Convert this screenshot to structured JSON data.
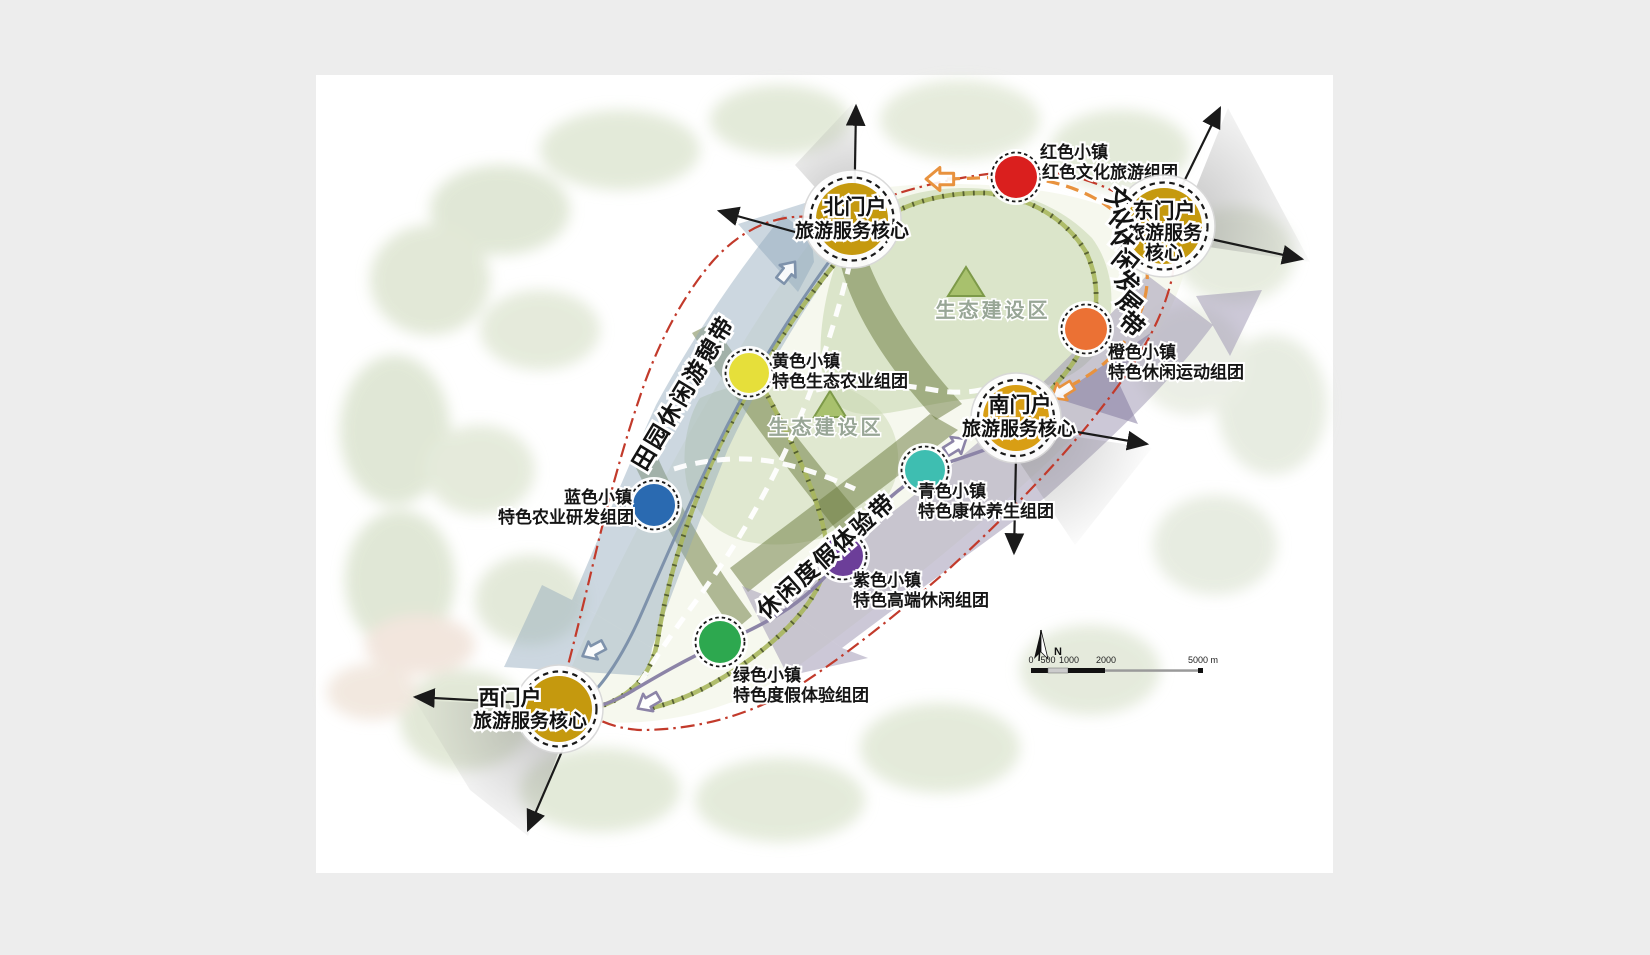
{
  "page": {
    "background": "#ededed",
    "canvas": "#ffffff"
  },
  "gateways": {
    "north": {
      "name": "北门户",
      "sub": "旅游服务核心",
      "color": "#C5990E"
    },
    "east": {
      "l1": "东门户",
      "l2": "旅游服务",
      "l3": "核心",
      "color": "#C5990E"
    },
    "south": {
      "name": "南门户",
      "sub": "旅游服务核心",
      "color": "#D89E14"
    },
    "west": {
      "name": "西门户",
      "sub": "旅游服务核心",
      "color": "#C5990E"
    }
  },
  "towns": {
    "red": {
      "name": "红色小镇",
      "desc": "红色文化旅游组团",
      "color": "#DA1F1E"
    },
    "orange": {
      "name": "橙色小镇",
      "desc": "特色休闲运动组团",
      "color": "#EB7134"
    },
    "yellow": {
      "name": "黄色小镇",
      "desc": "特色生态农业组团",
      "color": "#E6DF3A"
    },
    "blue": {
      "name": "蓝色小镇",
      "desc": "特色农业研发组团",
      "color": "#2A6AB1"
    },
    "teal": {
      "name": "青色小镇",
      "desc": "特色康体养生组团",
      "color": "#3EBEB1"
    },
    "purple": {
      "name": "紫色小镇",
      "desc": "特色高端休闲组团",
      "color": "#6C3E99"
    },
    "green": {
      "name": "绿色小镇",
      "desc": "特色度假体验组团",
      "color": "#2DA84F"
    }
  },
  "belts": {
    "rural": {
      "label": "田园休闲游憩带",
      "color": "#8FA6BB"
    },
    "culture": {
      "label": "文化休闲发展带",
      "color": "#9A92AF"
    },
    "leisure": {
      "label": "休闲度假体验带",
      "color": "#9A92AF"
    }
  },
  "eco_zone": {
    "label": "生态建设区",
    "fill": "#C9D8B2",
    "text_color": "#98A696"
  },
  "routes": {
    "scenic_red": {
      "color": "#C23A2B"
    },
    "orange": {
      "color": "#E8923E"
    },
    "purple": {
      "color": "#8C84A7"
    },
    "blue": {
      "color": "#7E92AB"
    },
    "road": {
      "color": "#A9B75E"
    }
  },
  "corridor": {
    "color": "#67773A"
  },
  "scale_bar": {
    "ticks": [
      "0",
      "500",
      "1000",
      "2000"
    ],
    "end": "5000 m",
    "north": "N"
  }
}
